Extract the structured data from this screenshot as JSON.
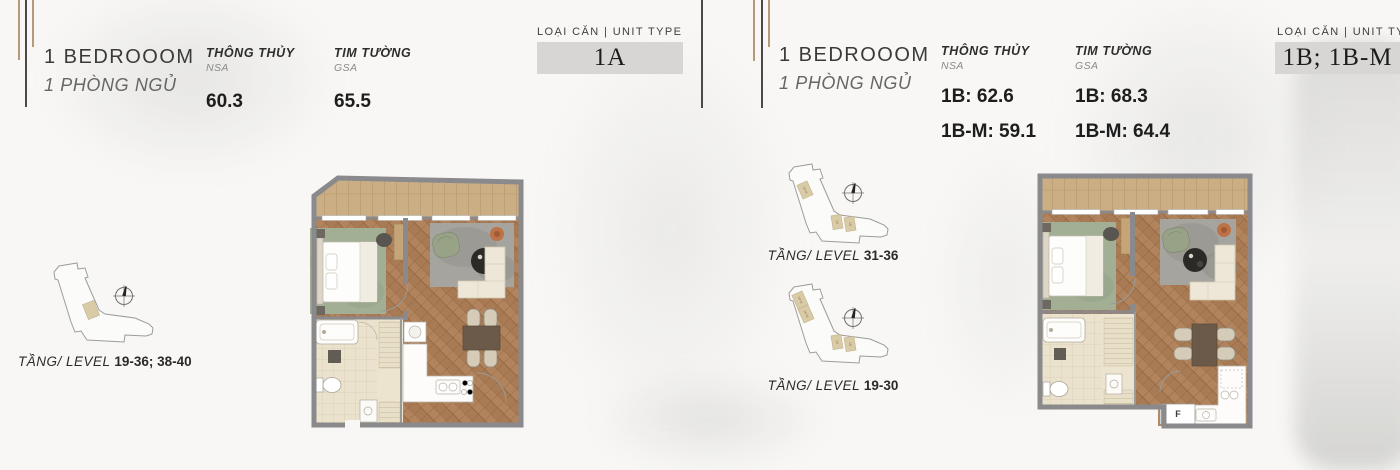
{
  "sections": {
    "left": {
      "title": "1 BEDROOOM",
      "subtitle": "1 PHÒNG NGỦ",
      "nsa": {
        "label": "THÔNG THỦY",
        "sublabel": "NSA",
        "values": [
          "60.3"
        ]
      },
      "gsa": {
        "label": "TIM TƯỜNG",
        "sublabel": "GSA",
        "values": [
          "65.5"
        ]
      },
      "unit_type": {
        "label": "LOẠI CĂN | UNIT TYPE",
        "value": "1A"
      },
      "key_plans": [
        {
          "level_label": "TẦNG/ LEVEL",
          "level_value": "19-36; 38-40",
          "unit_marks": []
        }
      ]
    },
    "right": {
      "title": "1 BEDROOOM",
      "subtitle": "1 PHÒNG NGỦ",
      "nsa": {
        "label": "THÔNG THỦY",
        "sublabel": "NSA",
        "values": [
          "1B: 62.6",
          "1B-M: 59.1"
        ]
      },
      "gsa": {
        "label": "TIM TƯỜNG",
        "sublabel": "GSA",
        "values": [
          "1B: 68.3",
          "1B-M: 64.4"
        ]
      },
      "unit_type": {
        "label": "LOẠI CĂN | UNIT TYPE",
        "value": "1B; 1B-M"
      },
      "key_plans": [
        {
          "level_label": "TẦNG/ LEVEL",
          "level_value": "31-36",
          "unit_marks": [
            "1B-M",
            "1B",
            "1B"
          ]
        },
        {
          "level_label": "TẦNG/ LEVEL",
          "level_value": "19-30",
          "unit_marks": [
            "1B-M",
            "1B-M",
            "1B",
            "1B"
          ]
        }
      ]
    }
  },
  "floor_plans": {
    "fridge_label": "F"
  },
  "colors": {
    "wall": "#8a8a8c",
    "wood_floor": "#b1835c",
    "balcony_wood": "#cbae83",
    "unit_box_bg": "#d7d6d4",
    "keyplan_highlight": "#d9cba6",
    "accent_line_tan": "#b49a76",
    "accent_line_dark": "#4d4a45"
  }
}
